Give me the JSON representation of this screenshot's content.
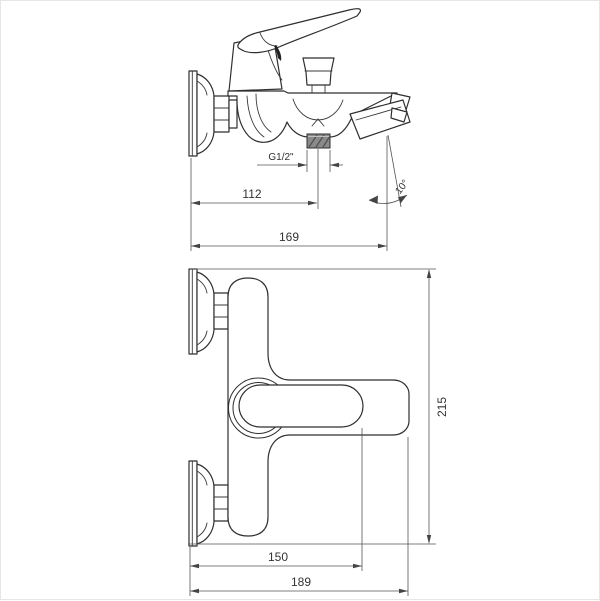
{
  "meta": {
    "drawing_title": "Wall-mounted bath mixer tap — dimensional drawing",
    "views": [
      "side view",
      "front view"
    ]
  },
  "colors": {
    "background": "#ffffff",
    "outline": "#2f2f2f",
    "dimension_lines": "#555555",
    "text": "#333333",
    "thread_fill": "#8a8a8a",
    "frame_border": "#e6e6e6"
  },
  "side_view": {
    "dimensions": {
      "thread": "G1/2\"",
      "wall_to_outlet": "112",
      "total_reach": "169",
      "spout_angle": "10°"
    }
  },
  "front_view": {
    "dimensions": {
      "wall_to_lever": "150",
      "total_width": "189",
      "total_height": "215"
    }
  }
}
